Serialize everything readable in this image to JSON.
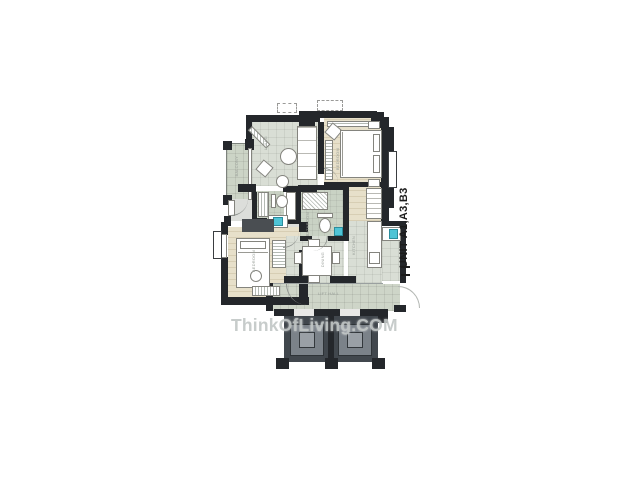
{
  "plan": {
    "unit_label": "UNIT A1,A3,B3",
    "watermark": "ThinkOfLiving.COM",
    "room_labels": {
      "balcony": "BALCONY",
      "living": "LIVING",
      "master_bedroom": "BEDROOM",
      "bedroom2": "BEDROOM",
      "bathroom1": "BATHROOM",
      "dining": "DINING",
      "kitchen": "KITCHEN",
      "lift_hall": "LIFT HALL"
    }
  },
  "colors": {
    "wall": "#24272b",
    "floor_grid": "#d9ded5",
    "floor_wood": "#e7e0ca",
    "floor_green": "#ccd4c6",
    "bath_green": "#c9d2c4",
    "corridor_green": "#ced5c8",
    "elevator_dark": "#41474d",
    "elevator_mid": "#7b8289",
    "fixture_teal": "#4fc4d6",
    "watermark_gray": "#c3c8c7",
    "label_gray": "#979d97"
  }
}
